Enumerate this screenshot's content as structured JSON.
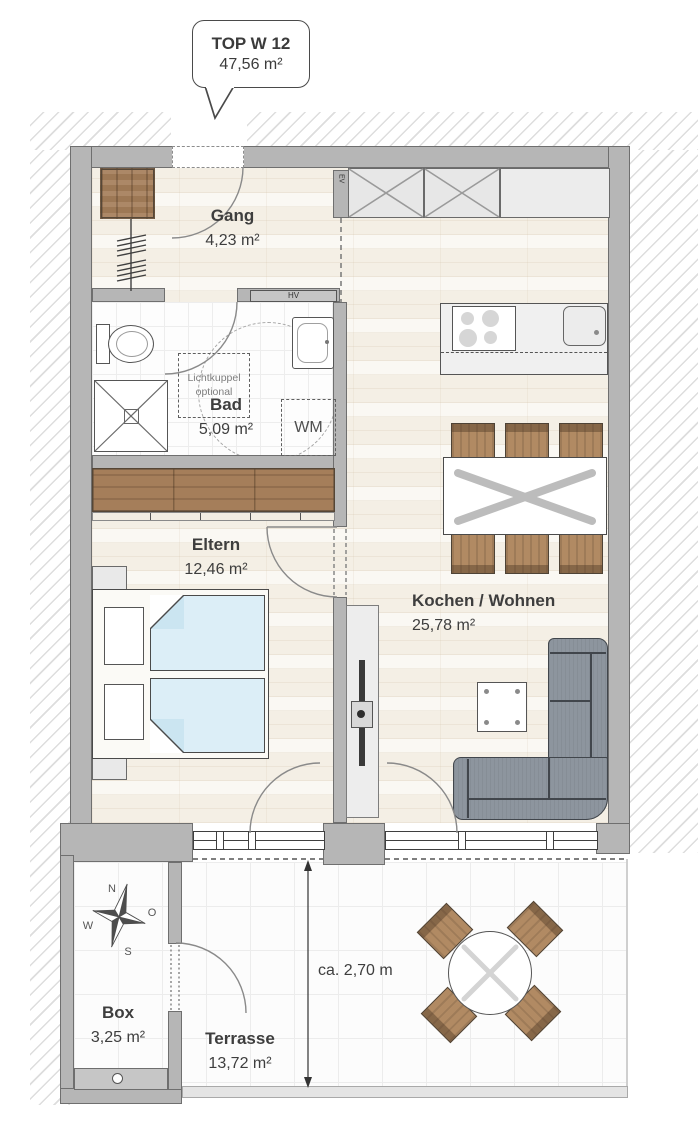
{
  "callout": {
    "title": "TOP W 12",
    "area": "47,56 m²"
  },
  "rooms": {
    "gang": {
      "name": "Gang",
      "area": "4,23 m²"
    },
    "bad": {
      "name": "Bad",
      "area": "5,09 m²"
    },
    "eltern": {
      "name": "Eltern",
      "area": "12,46 m²"
    },
    "wohnen": {
      "name": "Kochen / Wohnen",
      "area": "25,78 m²"
    },
    "box": {
      "name": "Box",
      "area": "3,25 m²"
    },
    "terrasse": {
      "name": "Terrasse",
      "area": "13,72 m²"
    }
  },
  "annotations": {
    "skylight": "Lichtkuppel optional",
    "washing_machine": "WM",
    "distribution_board": "HV",
    "meter": "EV",
    "terrace_depth": "ca. 2,70 m"
  },
  "compass": {
    "n": "N",
    "e": "O",
    "s": "S",
    "w": "W"
  },
  "colors": {
    "wall": "#b6b6b6",
    "wood_furniture": "#a57e5a",
    "wood_floor": "#f4efe5",
    "bed": "#dceef7",
    "sofa": "#8d959e",
    "outline": "#4a4a4a"
  }
}
